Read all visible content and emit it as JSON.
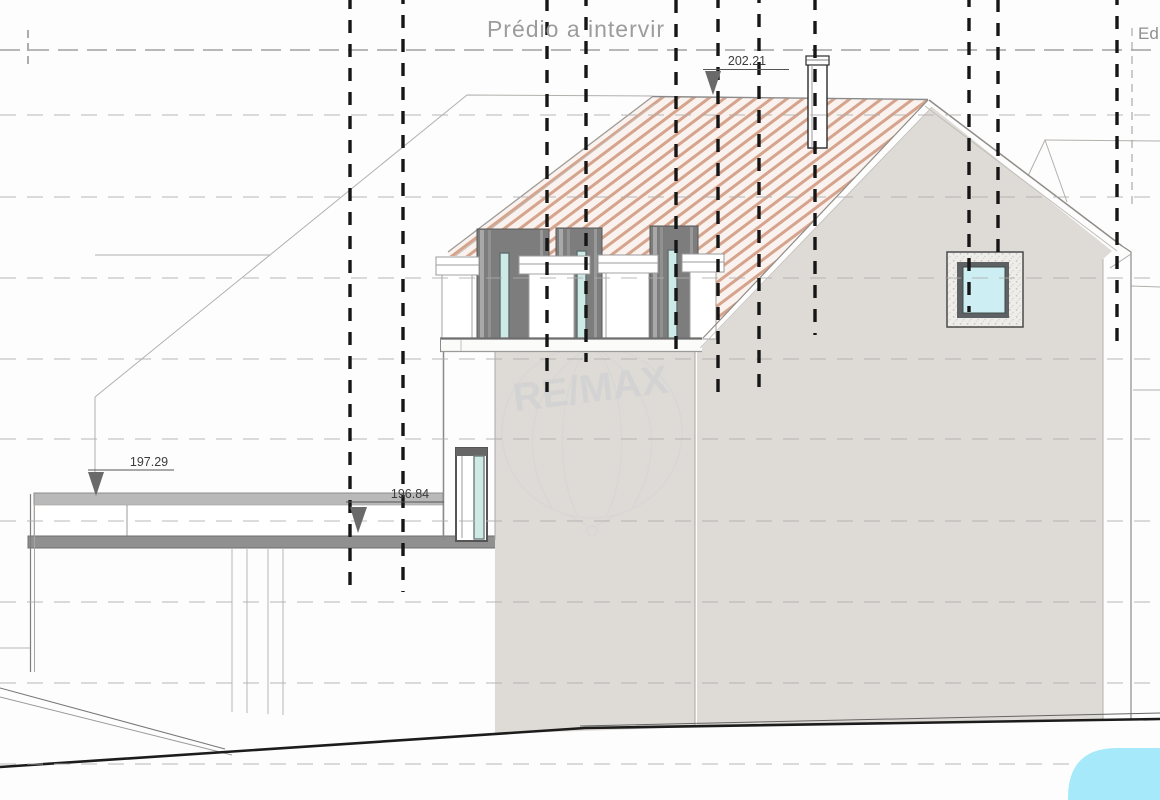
{
  "title": {
    "text": "Prédio a intervir"
  },
  "edge_label": {
    "text": "Ed"
  },
  "markers": {
    "ridge": "202.21",
    "terrace": "197.29",
    "slab": "196.84"
  },
  "watermark": {
    "text": "RE/MAX"
  },
  "colors": {
    "roof_hatch_stripe": "#d6a38c",
    "roof_hatch_bg": "#f9f2ee",
    "wall_fill": "#dedad5",
    "dormer_dark": "#7d7d7d",
    "dormer_glass": "#cdeae6",
    "window_glass": "#cdeef2",
    "parapet_gray": "#b9b9b9",
    "slab_gray": "#909090",
    "section_line": "#161616",
    "grid_line": "#adadad",
    "accent_blue": "#a5e9fb",
    "text_gray": "#9c9c9c",
    "marker_text": "#3c3c3c"
  }
}
